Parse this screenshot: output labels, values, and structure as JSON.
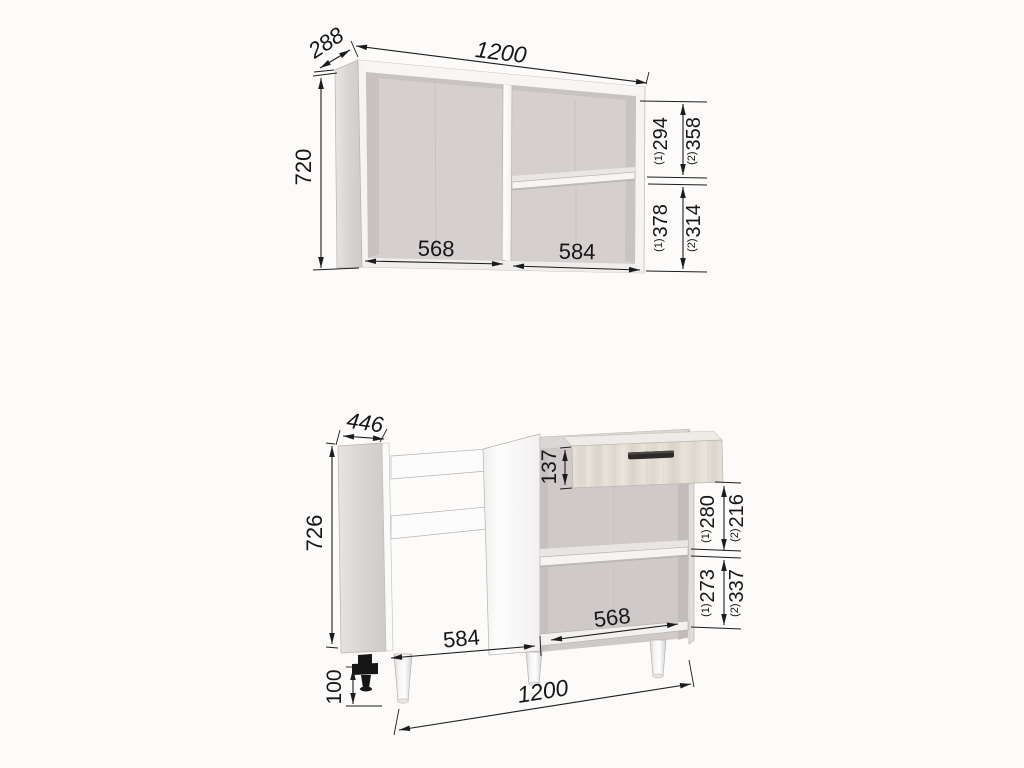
{
  "drawing": {
    "title": "kitchen cabinet dimension drawing"
  },
  "wall_cabinet": {
    "width": "1200",
    "depth": "288",
    "height": "720",
    "left_opening_width": "568",
    "right_opening_width": "584",
    "top_section": {
      "opt1_mark": "(1)",
      "opt1": "294",
      "opt2_mark": "(2)",
      "opt2": "358"
    },
    "bottom_section": {
      "opt1_mark": "(1)",
      "opt1": "378",
      "opt2_mark": "(2)",
      "opt2": "314"
    }
  },
  "base_cabinet": {
    "depth": "446",
    "height": "726",
    "leg_height": "100",
    "width": "1200",
    "drawer_front_height": "137",
    "left_opening_width": "584",
    "right_opening_width": "568",
    "top_section": {
      "opt1_mark": "(1)",
      "opt1": "280",
      "opt2_mark": "(2)",
      "opt2": "216"
    },
    "bottom_section": {
      "opt1_mark": "(1)",
      "opt1": "273",
      "opt2_mark": "(2)",
      "opt2": "337"
    }
  },
  "colors": {
    "line": "#1c1c1c",
    "carcass_grey": "#d5d0cf",
    "edge_white": "#f7f5f4",
    "wood_light": "#e4dfd6",
    "handle_dark": "#2b2a29",
    "background": "#fcfbfa"
  }
}
